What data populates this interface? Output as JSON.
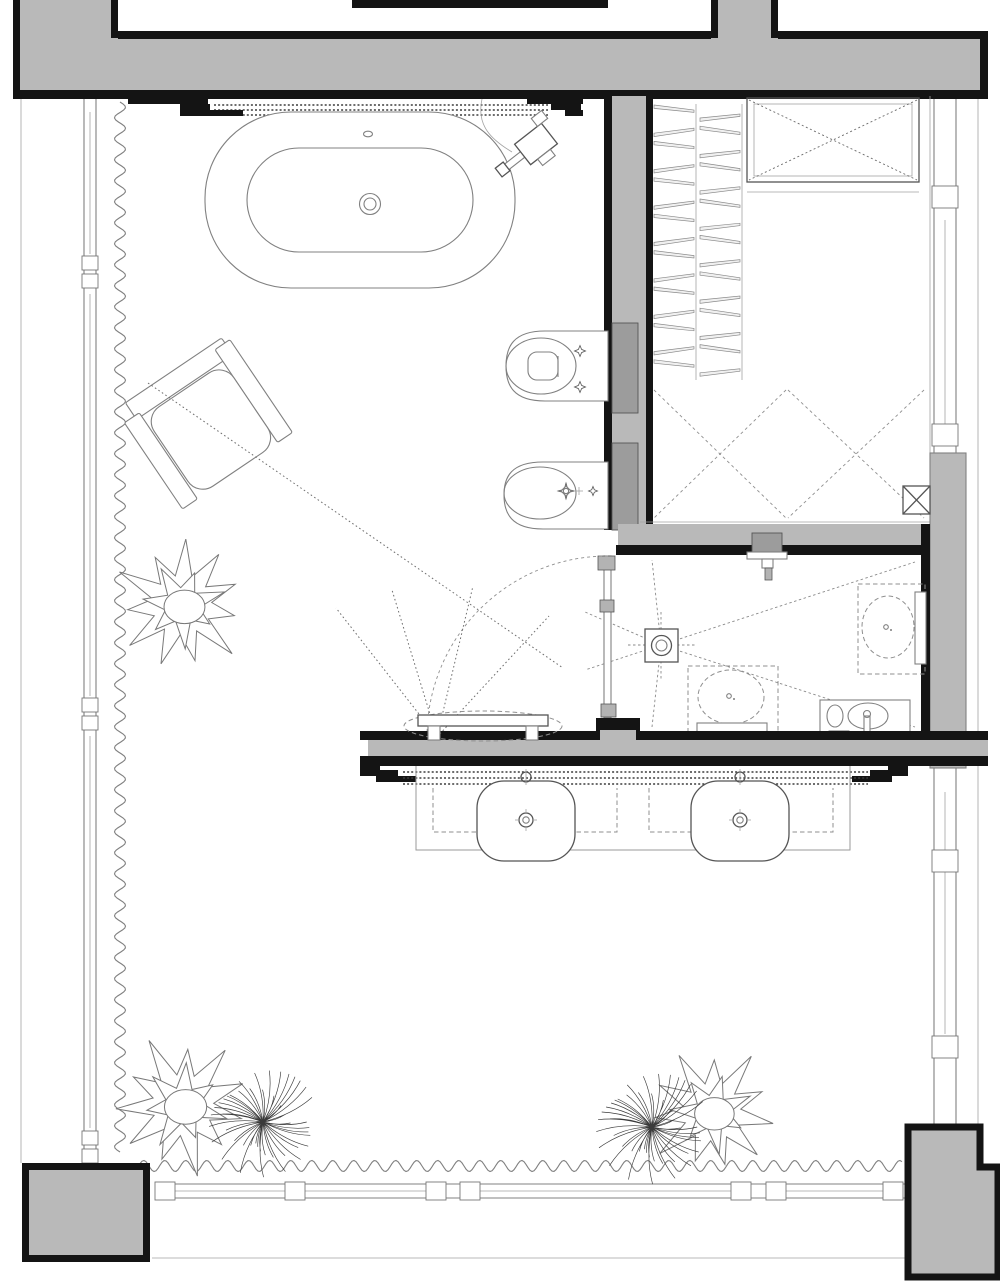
{
  "page": {
    "kind": "architectural-floor-plan",
    "background": "#ffffff"
  },
  "colors": {
    "wall_fill": "#b9b9b9",
    "wall_dark": "#141414",
    "fixture_gray": "#9c9c9c",
    "clip_gray": "#b3b3b3",
    "line_strong": "#555555",
    "line": "#808080",
    "line_light": "#a3a3a3",
    "dash": "#8f8f8f",
    "dot": "#6f6f6f",
    "floor": "#ffffff"
  },
  "plan": {
    "rooms": [
      {
        "name": "main-bathroom"
      },
      {
        "name": "walk-in-closet"
      },
      {
        "name": "shower-room"
      },
      {
        "name": "window-front-area"
      }
    ],
    "fixtures": [
      {
        "name": "bathtub-oval-freestanding"
      },
      {
        "name": "floor-standing-tub-filler"
      },
      {
        "name": "wall-hung-toilet"
      },
      {
        "name": "wall-hung-bidet"
      },
      {
        "name": "concealed-cistern-left"
      },
      {
        "name": "concealed-cistern-right"
      },
      {
        "name": "shower-floor-drain"
      },
      {
        "name": "wall-mounted-shower-head"
      },
      {
        "name": "small-hand-basin"
      },
      {
        "name": "vanity-basin-left"
      },
      {
        "name": "vanity-basin-right"
      },
      {
        "name": "vanity-counter"
      },
      {
        "name": "bench-stool"
      },
      {
        "name": "armchair"
      },
      {
        "name": "wardrobe-hanger-rails"
      },
      {
        "name": "wardrobe-top-cabinet-crossed"
      },
      {
        "name": "glass-pivot-door"
      },
      {
        "name": "plant-left"
      },
      {
        "name": "plant-bottom-left-pair"
      },
      {
        "name": "plant-bottom-center-pair"
      }
    ],
    "symbols": [
      {
        "name": "curtain-wave-line"
      },
      {
        "name": "recessed-sliding-track-dotted"
      },
      {
        "name": "door-swing-arc-dashed"
      },
      {
        "name": "floor-slope-lines-dashed"
      },
      {
        "name": "sight-line-dotted"
      },
      {
        "name": "shaft-box-crossed"
      },
      {
        "name": "window-mullion-boxes"
      },
      {
        "name": "concrete-columns"
      }
    ]
  }
}
